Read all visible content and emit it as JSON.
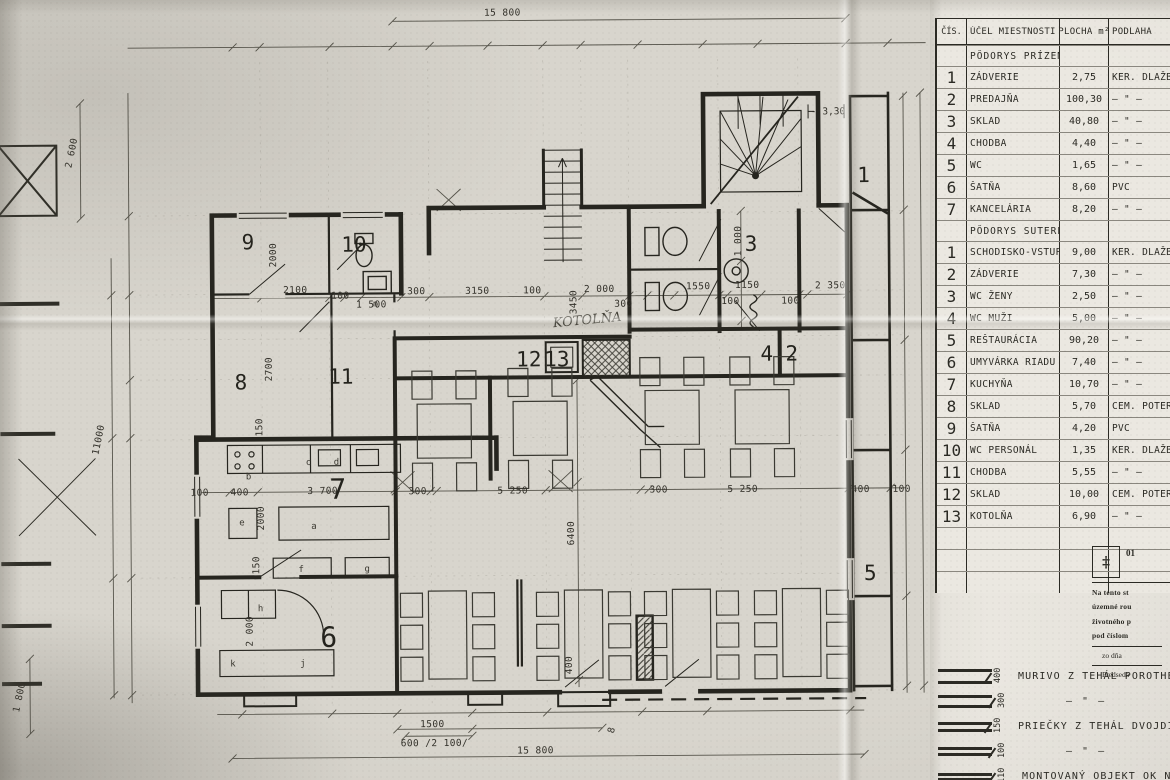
{
  "colors": {
    "paper": "#d8d5cd",
    "panel": "#ebe8e1",
    "ink": "#26251f",
    "pencil": "#6e6b62"
  },
  "plan": {
    "rooms": {
      "n1": "1",
      "n2": "2",
      "n3": "3",
      "n4": "4",
      "n5": "5",
      "n6": "6",
      "n7": "7",
      "n8": "8",
      "n8b": "8",
      "n9": "9",
      "n10": "10",
      "n11": "11",
      "n12": "12",
      "n13": "13"
    },
    "equipment": {
      "a": "a",
      "b": "b",
      "c": "c",
      "d": "d",
      "e": "e",
      "f": "f",
      "g": "g",
      "h": "h",
      "j": "j",
      "k": "k",
      "n": "n"
    },
    "notes": {
      "kotolna": "KOTOLŇA",
      "level": "- 3,30"
    },
    "dims": {
      "top": "15 800",
      "bottom_a": "1500",
      "bottom_b": "600 /2 100/",
      "bottom_total": "15 800",
      "left_a": "2 600",
      "left_b": "11000",
      "left_c": "1 800",
      "d2100": "2100",
      "d100a": "100",
      "d1500": "1 500",
      "d300a": "300",
      "d3150": "3150",
      "d100b": "100",
      "d3450": "3450",
      "d2000a": "2 000",
      "d300b": "300",
      "d1550": "1550",
      "d1150": "1150",
      "d100c": "100",
      "d100d": "100",
      "d2350": "2 350",
      "d1000": "1 000",
      "k100": "100",
      "k400": "400",
      "k3700": "3 700",
      "k2000": "2000",
      "k150a": "150",
      "k150b": "150",
      "r9_2000": "2000",
      "r8_2700": "2700",
      "r6_2000": "2 000",
      "m300a": "300",
      "m5250a": "5 250",
      "m300b": "300",
      "m5250b": "5 250",
      "m6400": "6400",
      "m400": "400",
      "r5_400": "400",
      "r5_100": "100"
    }
  },
  "schedule": {
    "headers": {
      "num": "ČÍS.",
      "name": "ÚČEL MIESTNOSTI",
      "area": "PLOCHA m²",
      "floor": "PODLAHA"
    },
    "section_ground": {
      "title": "PÔDORYS PRÍZEMIA",
      "rows": [
        {
          "num": "1",
          "name": "ZÁDVERIE",
          "area": "2,75",
          "floor": "KER. DLAŽBA"
        },
        {
          "num": "2",
          "name": "PREDAJŇA",
          "area": "100,30",
          "floor": "— \" —"
        },
        {
          "num": "3",
          "name": "SKLAD",
          "area": "40,80",
          "floor": "— \" —"
        },
        {
          "num": "4",
          "name": "CHODBA",
          "area": "4,40",
          "floor": "— \" —"
        },
        {
          "num": "5",
          "name": "WC",
          "area": "1,65",
          "floor": "— \" —"
        },
        {
          "num": "6",
          "name": "ŠATŇA",
          "area": "8,60",
          "floor": "PVC"
        },
        {
          "num": "7",
          "name": "KANCELÁRIA",
          "area": "8,20",
          "floor": "— \" —"
        }
      ]
    },
    "section_basement": {
      "title": "PÔDORYS SUTERÉNU",
      "rows": [
        {
          "num": "1",
          "name": "SCHODISKO-VSTUP",
          "area": "9,00",
          "floor": "KER. DLAŽBA"
        },
        {
          "num": "2",
          "name": "ZÁDVERIE",
          "area": "7,30",
          "floor": "— \" —"
        },
        {
          "num": "3",
          "name": "WC ŽENY",
          "area": "2,50",
          "floor": "— \" —"
        },
        {
          "num": "4",
          "name": "WC MUŽI",
          "area": "5,00",
          "floor": "— \" —"
        },
        {
          "num": "5",
          "name": "REŠTAURÁCIA",
          "area": "90,20",
          "floor": "— \" —"
        },
        {
          "num": "6",
          "name": "UMYVÁRKA RIADU",
          "area": "7,40",
          "floor": "— \" —"
        },
        {
          "num": "7",
          "name": "KUCHYŇA",
          "area": "10,70",
          "floor": "— \" —"
        },
        {
          "num": "8",
          "name": "SKLAD",
          "area": "5,70",
          "floor": "CEM. POTER"
        },
        {
          "num": "9",
          "name": "ŠATŇA",
          "area": "4,20",
          "floor": "PVC"
        },
        {
          "num": "10",
          "name": "WC PERSONÁL",
          "area": "1,35",
          "floor": "KER. DLAŽBA"
        },
        {
          "num": "11",
          "name": "CHODBA",
          "area": "5,55",
          "floor": "— \" —"
        },
        {
          "num": "12",
          "name": "SKLAD",
          "area": "10,00",
          "floor": "CEM. POTER"
        },
        {
          "num": "13",
          "name": "KOTOLŇA",
          "area": "6,90",
          "floor": "— \" —"
        }
      ]
    }
  },
  "stamp": {
    "code": "01",
    "emblem": "‡",
    "lines": [
      "Na tento st",
      "územné rou",
      "životného p",
      "pod číslom"
    ],
    "date_label": "zo dňa",
    "sign_label": "Predseda"
  },
  "wall_legend": {
    "items": [
      {
        "dim": "400",
        "label": "MURIVO Z TEHÁL POROTHERM"
      },
      {
        "dim": "300",
        "label": "— \" —"
      },
      {
        "dim": "150",
        "label": "PRIEČKY Z TEHÁL DVOJDIER."
      },
      {
        "dim": "100",
        "label": "— \" —"
      },
      {
        "dim": "110",
        "label": "MONTOVANÝ OBJEKT OK N"
      }
    ]
  }
}
